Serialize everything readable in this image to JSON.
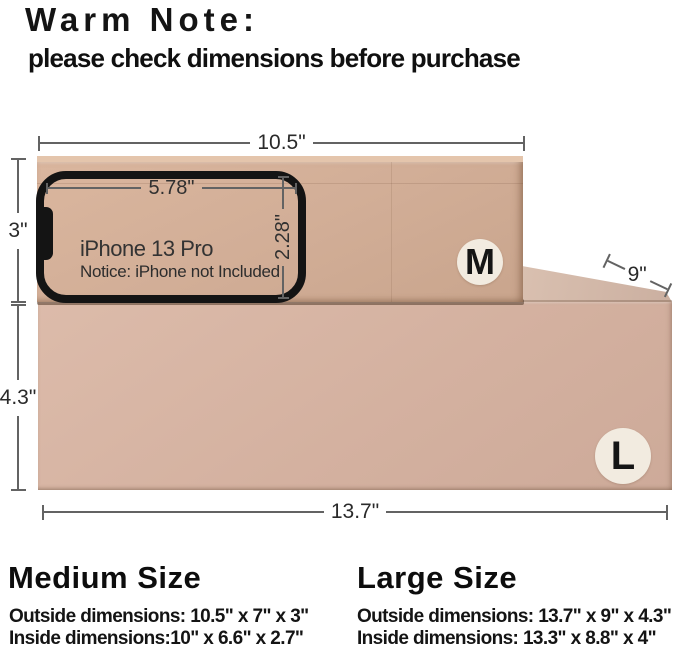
{
  "header": {
    "title": "Warm Note:",
    "subtitle": "please check dimensions before purchase"
  },
  "scene": {
    "medium_box": {
      "sticker": "M",
      "width_label": "10.5\"",
      "height_label": "3\""
    },
    "large_box": {
      "sticker": "L",
      "width_label": "13.7\"",
      "height_label": "4.3\"",
      "depth_label": "9\""
    },
    "phone": {
      "model": "iPhone 13 Pro",
      "notice": "Notice: iPhone not Included",
      "width_label": "5.78\"",
      "height_label": "2.28\""
    },
    "colors": {
      "medium_box_face": "#d2ae97",
      "large_box_face": "#d4b1a0",
      "large_box_top": "#d0b5a5",
      "sticker_bg": "#f2ebe0",
      "dimension_line": "#636363",
      "phone_outline": "#141414",
      "text": "#111111"
    }
  },
  "footer": {
    "medium": {
      "heading": "Medium Size",
      "outside": "Outside dimensions: 10.5\" x 7\" x 3\"",
      "inside": "Inside dimensions:10\" x 6.6\" x 2.7\""
    },
    "large": {
      "heading": "Large Size",
      "outside": "Outside dimensions: 13.7\" x 9\" x 4.3\"",
      "inside": "Inside dimensions: 13.3\" x 8.8\" x 4\""
    }
  }
}
